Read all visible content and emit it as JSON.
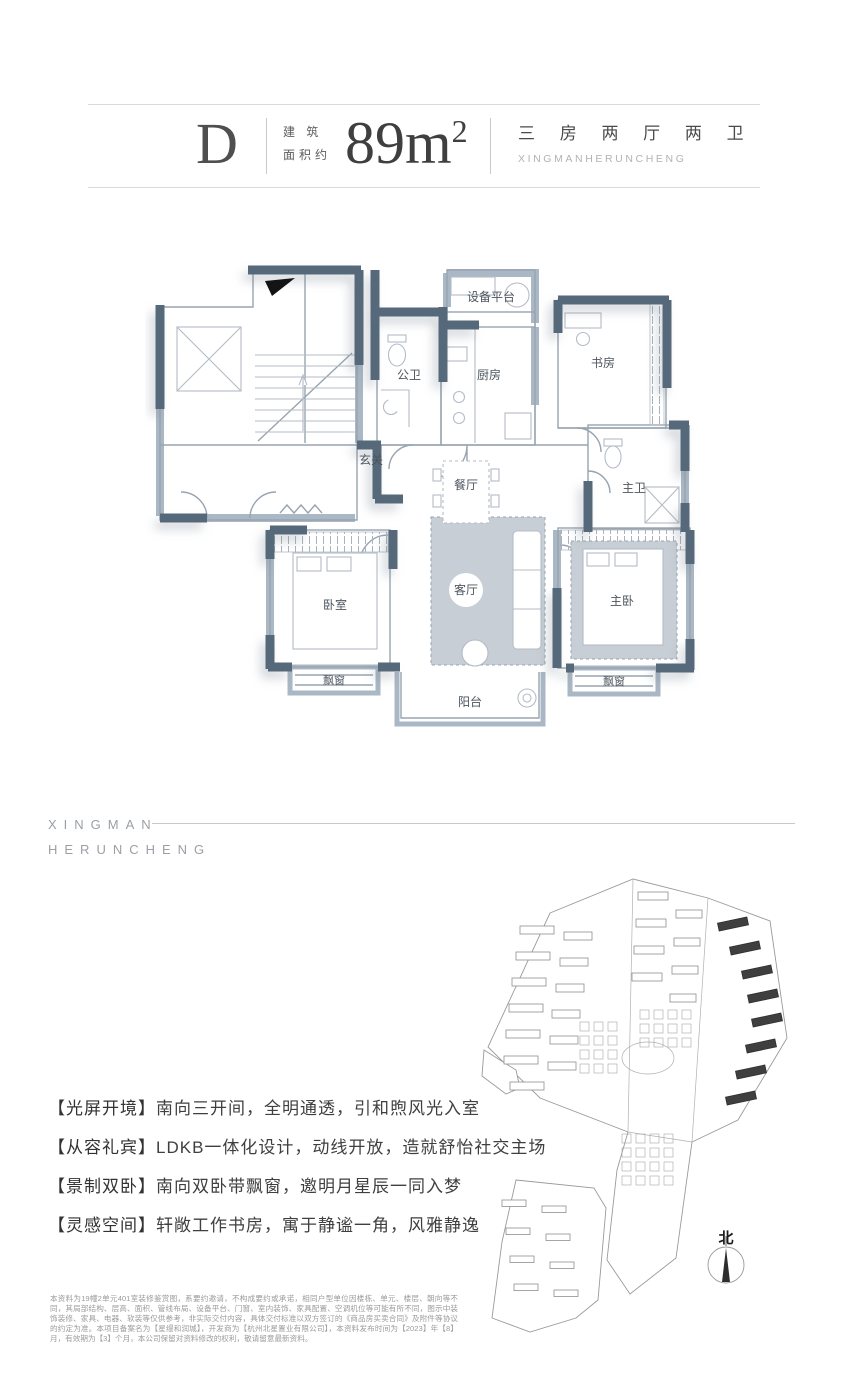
{
  "header": {
    "unit": "D",
    "area_prefix_line1": "建 筑",
    "area_prefix_line2": "面积约",
    "area_value": "89m",
    "area_exponent": "2",
    "layout_cn": "三 房 两 厅 两 卫",
    "brand_en": "XINGMANHERUNCHENG"
  },
  "brand_block": {
    "line1": "XINGMAN",
    "line2": "HERUNCHENG"
  },
  "floorplan": {
    "rooms": [
      {
        "label": "设备平台"
      },
      {
        "label": "公卫"
      },
      {
        "label": "厨房"
      },
      {
        "label": "书房"
      },
      {
        "label": "玄关"
      },
      {
        "label": "餐厅"
      },
      {
        "label": "主卫"
      },
      {
        "label": "卧室"
      },
      {
        "label": "客厅"
      },
      {
        "label": "主卧"
      },
      {
        "label": "飘窗"
      },
      {
        "label": "飘窗"
      },
      {
        "label": "阳台"
      }
    ]
  },
  "features": [
    {
      "label": "【光屏开境】",
      "text": "南向三开间，全明通透，引和煦风光入室"
    },
    {
      "label": "【从容礼宾】",
      "text": "LDKB一体化设计，动线开放，造就舒怡社交主场"
    },
    {
      "label": "【景制双卧】",
      "text": "南向双卧带飘窗，邀明月星辰一同入梦"
    },
    {
      "label": "【灵感空间】",
      "text": "轩敞工作书房，寓于静谧一角，风雅静逸"
    }
  ],
  "site_map": {
    "north_label": "北"
  },
  "disclaimer": "本资料为19幢2单元401室装修鉴赏图，系要约邀请，不构成要约或承诺，相同户型单位因楼栋、单元、楼层、朝向等不同，其局部结构、层高、面积、管线布局、设备平台、门窗、室内装饰、家具配置、空调机位等可能有所不同，图示中装饰装修、家具、电器、软装等仅供参考，非实际交付内容，具体交付标准以双方签订的《商品房买卖合同》及附件等协议的约定为准。本项目备案名为【星缦和润城】，开发商为【杭州北星置业有限公司】，本资料发布时间为【2023】年【8】月，有效期为【3】个月，本公司保留对资料修改的权利，敬请留意最新资料。",
  "colors": {
    "wall_dark": "#56697b",
    "wall_light": "#aab7c4",
    "rug": "#c7ced5"
  }
}
